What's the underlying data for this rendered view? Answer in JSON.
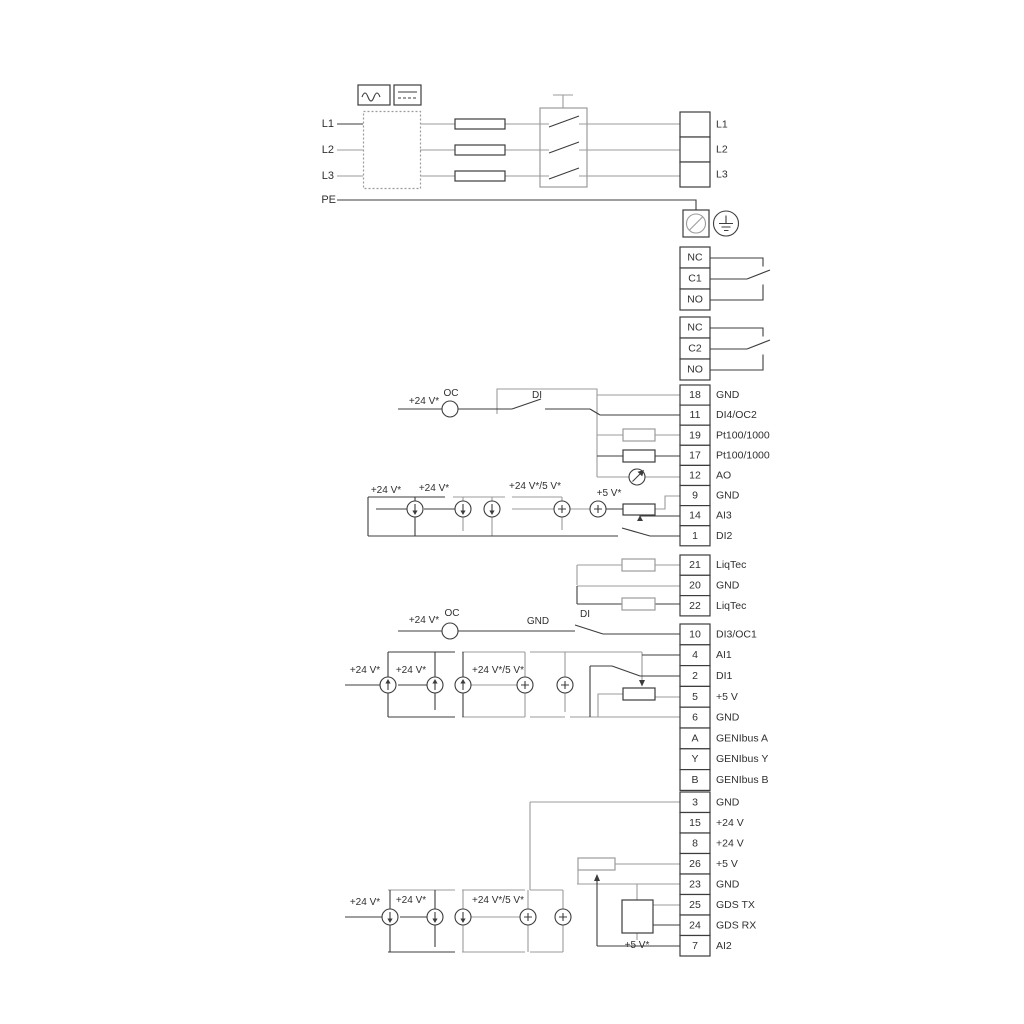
{
  "diagram": {
    "power_input": {
      "labels": [
        "L1",
        "L2",
        "L3",
        "PE"
      ]
    },
    "power_output": {
      "labels": [
        "L1",
        "L2",
        "L3"
      ]
    },
    "relay1": {
      "cells": [
        "NC",
        "C1",
        "NO"
      ]
    },
    "relay2": {
      "cells": [
        "NC",
        "C2",
        "NO"
      ]
    },
    "terminal_block_mid": {
      "terminals": [
        {
          "num": "18",
          "label": "GND"
        },
        {
          "num": "11",
          "label": "DI4/OC2"
        },
        {
          "num": "19",
          "label": "Pt100/1000"
        },
        {
          "num": "17",
          "label": "Pt100/1000"
        },
        {
          "num": "12",
          "label": "AO"
        },
        {
          "num": "9",
          "label": "GND"
        },
        {
          "num": "14",
          "label": "AI3"
        },
        {
          "num": "1",
          "label": "DI2"
        }
      ]
    },
    "terminal_block_liqtec": {
      "terminals": [
        {
          "num": "21",
          "label": "LiqTec"
        },
        {
          "num": "20",
          "label": "GND"
        },
        {
          "num": "22",
          "label": "LiqTec"
        }
      ]
    },
    "terminal_block_low": {
      "terminals": [
        {
          "num": "10",
          "label": "DI3/OC1"
        },
        {
          "num": "4",
          "label": "AI1"
        },
        {
          "num": "2",
          "label": "DI1"
        },
        {
          "num": "5",
          "label": "+5 V"
        },
        {
          "num": "6",
          "label": "GND"
        },
        {
          "num": "A",
          "label": "GENIbus A"
        },
        {
          "num": "Y",
          "label": "GENIbus Y"
        },
        {
          "num": "B",
          "label": "GENIbus B"
        }
      ]
    },
    "terminal_block_bottom": {
      "terminals": [
        {
          "num": "3",
          "label": "GND"
        },
        {
          "num": "15",
          "label": "+24 V"
        },
        {
          "num": "8",
          "label": "+24 V"
        },
        {
          "num": "26",
          "label": "+5 V"
        },
        {
          "num": "23",
          "label": "GND"
        },
        {
          "num": "25",
          "label": "GDS TX"
        },
        {
          "num": "24",
          "label": "GDS RX"
        },
        {
          "num": "7",
          "label": "AI2"
        }
      ]
    },
    "annotations": {
      "plus24": "+24 V*",
      "plus24_5": "+24 V*/5 V*",
      "plus5": "+5 V*",
      "oc": "OC",
      "di": "DI",
      "gnd": "GND"
    },
    "colors": {
      "wire_gray": "#9b9b9b",
      "wire_dark": "#3c3c3c",
      "text": "#303030"
    }
  }
}
